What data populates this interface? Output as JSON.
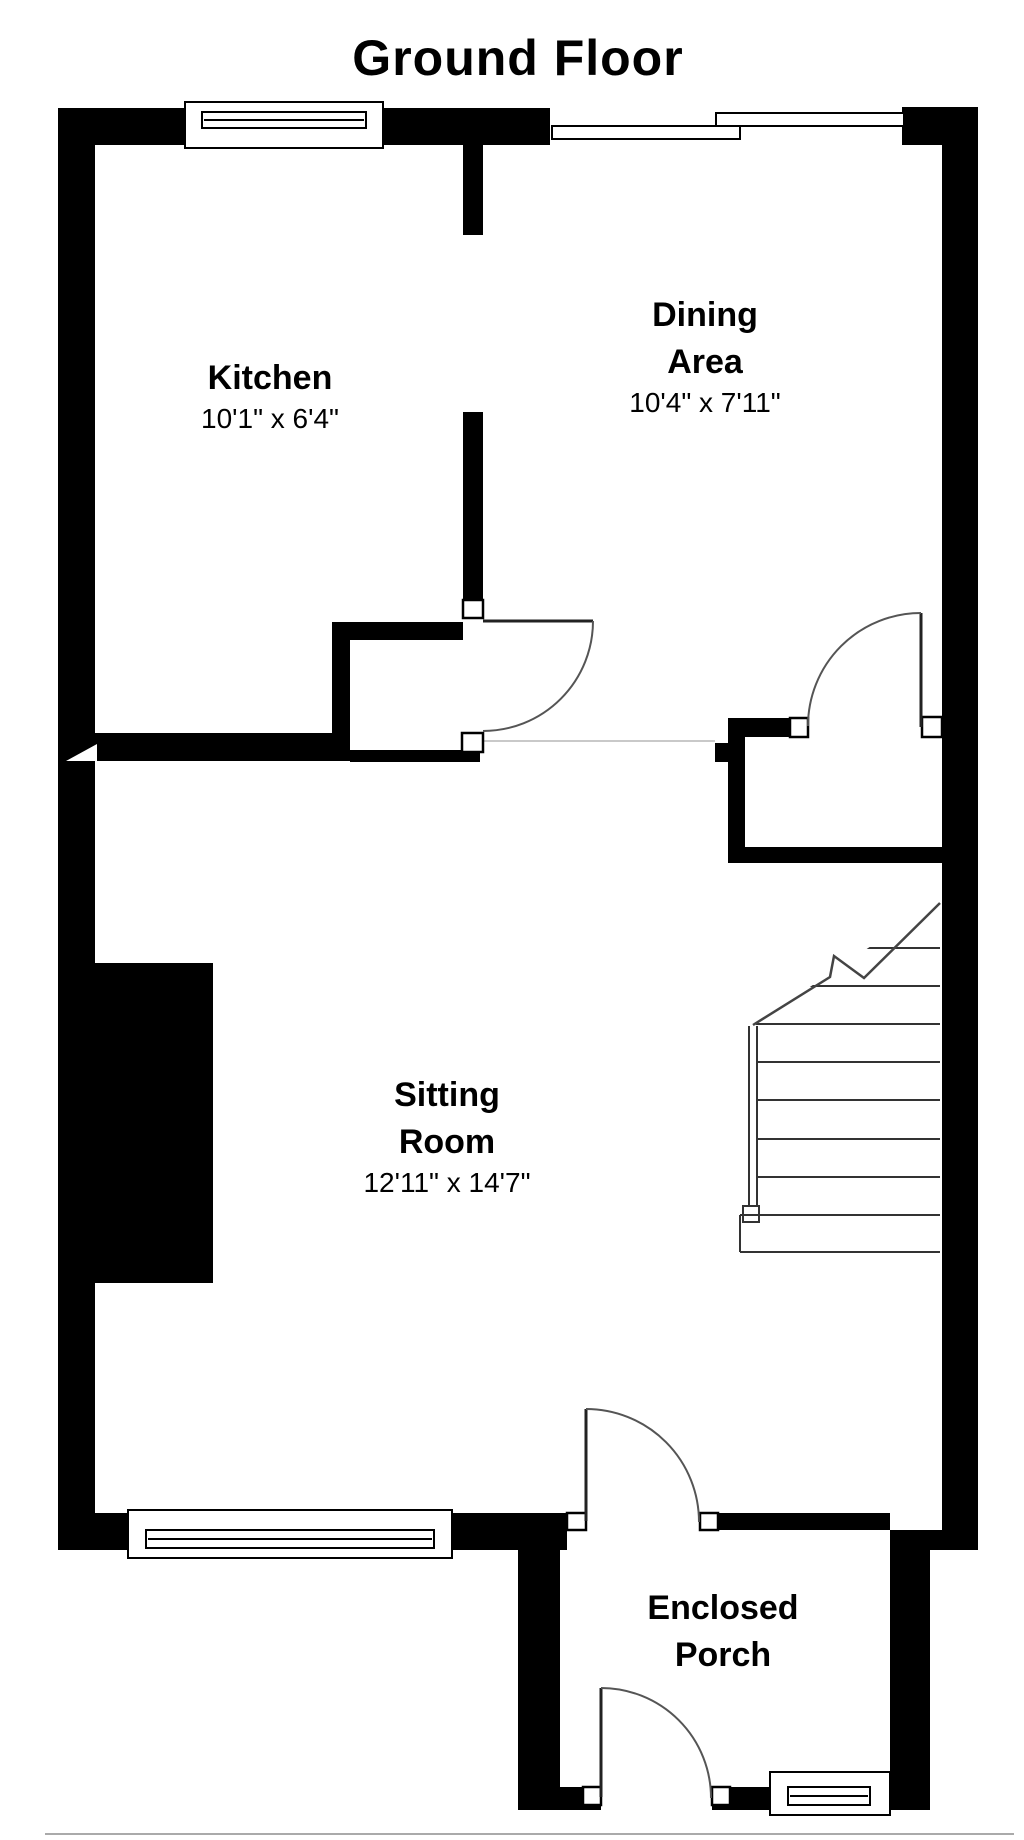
{
  "title": "Ground Floor",
  "rooms": {
    "kitchen": {
      "name": "Kitchen",
      "dims": "10'1\" x 6'4\""
    },
    "dining": {
      "name_line1": "Dining",
      "name_line2": "Area",
      "dims": "10'4\" x 7'11\""
    },
    "sitting": {
      "name_line1": "Sitting",
      "name_line2": "Room",
      "dims": "12'11\" x 14'7\""
    },
    "porch": {
      "name_line1": "Enclosed",
      "name_line2": "Porch"
    }
  },
  "features": {
    "windows": [
      "kitchen-top-window",
      "dining-top-window-left",
      "dining-top-window-right",
      "sitting-bottom-window",
      "porch-bottom-window"
    ],
    "doors": [
      "kitchen-door",
      "dining-hall-door",
      "sitting-porch-door",
      "porch-front-door"
    ],
    "stairs": {
      "treads": 9,
      "has_break_line": true,
      "location": "right-middle"
    }
  },
  "colors": {
    "wall": "#000000",
    "background": "#ffffff",
    "door_arc": "#555555",
    "stair_line": "#333333",
    "faint_line": "#c9c9c9",
    "bottom_border": "#aaaaaa"
  }
}
